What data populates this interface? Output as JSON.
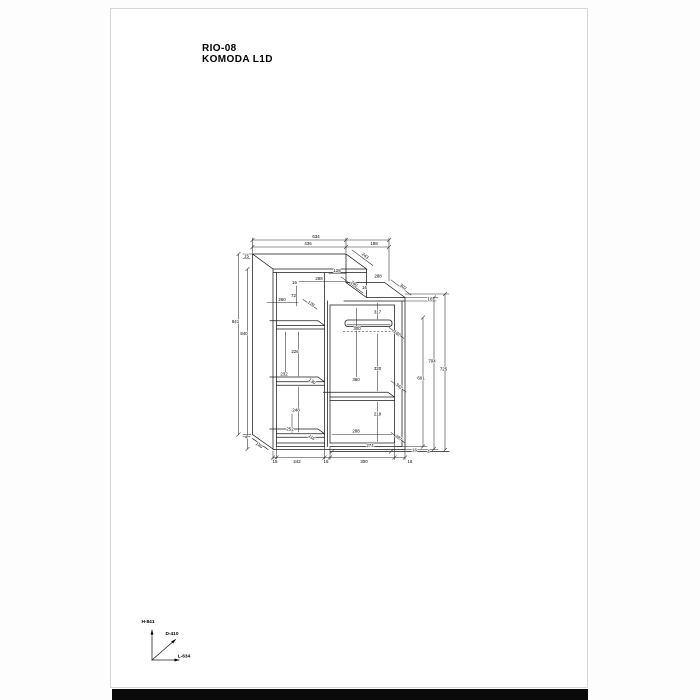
{
  "page": {
    "title_line1": "RIO-08",
    "title_line2": "KOMODA L1D"
  },
  "drawing": {
    "product_code": "RIO-08",
    "product_name": "KOMODA L1D",
    "line_color": "#1a1a1a",
    "page_background": "#ffffff",
    "axis_labels": [
      {
        "t": "H-841",
        "x": 148,
        "y": 621.5,
        "r": 0
      },
      {
        "t": "D-410",
        "x": 172,
        "y": 633.5,
        "r": 0
      },
      {
        "t": "L-634",
        "x": 184,
        "y": 656,
        "r": 0
      }
    ],
    "dimension_labels": [
      {
        "t": "634",
        "x": 316,
        "y": 237,
        "r": 0
      },
      {
        "t": "436",
        "x": 308,
        "y": 244,
        "r": 0
      },
      {
        "t": "198",
        "x": 374,
        "y": 244,
        "r": 0
      },
      {
        "t": "243",
        "x": 365,
        "y": 256,
        "r": 36
      },
      {
        "t": "15",
        "x": 246.5,
        "y": 256.5,
        "r": 0
      },
      {
        "t": "128",
        "x": 337,
        "y": 271,
        "r": 0
      },
      {
        "t": "288",
        "x": 319,
        "y": 279,
        "r": 0
      },
      {
        "t": "16",
        "x": 294.5,
        "y": 283,
        "r": 0
      },
      {
        "t": "240",
        "x": 354,
        "y": 284,
        "r": 36
      },
      {
        "t": "16",
        "x": 364.5,
        "y": 288,
        "r": 0
      },
      {
        "t": "288",
        "x": 378,
        "y": 276.5,
        "r": 0
      },
      {
        "t": "302",
        "x": 403,
        "y": 287,
        "r": 36
      },
      {
        "t": "72",
        "x": 293.5,
        "y": 296,
        "r": 0
      },
      {
        "t": "260",
        "x": 282,
        "y": 300,
        "r": 0
      },
      {
        "t": "128",
        "x": 311,
        "y": 304,
        "r": 36
      },
      {
        "t": "317",
        "x": 377.5,
        "y": 312.5,
        "r": 0
      },
      {
        "t": "16",
        "x": 430,
        "y": 299.5,
        "r": 0
      },
      {
        "t": "300",
        "x": 357,
        "y": 329,
        "r": 0
      },
      {
        "t": "182",
        "x": 397,
        "y": 333.5,
        "r": 36
      },
      {
        "t": "841",
        "x": 235.5,
        "y": 322,
        "r": 0
      },
      {
        "t": "840",
        "x": 244,
        "y": 334,
        "r": 0
      },
      {
        "t": "226",
        "x": 295,
        "y": 352,
        "r": 0
      },
      {
        "t": "232",
        "x": 284,
        "y": 374.5,
        "r": 0
      },
      {
        "t": "130",
        "x": 312,
        "y": 381.5,
        "r": 36
      },
      {
        "t": "248",
        "x": 296,
        "y": 410.5,
        "r": 0
      },
      {
        "t": "252",
        "x": 290,
        "y": 429.5,
        "r": 0
      },
      {
        "t": "116",
        "x": 311.5,
        "y": 437.5,
        "r": 36
      },
      {
        "t": "140",
        "x": 259,
        "y": 445.5,
        "r": 36
      },
      {
        "t": "4",
        "x": 246,
        "y": 437.5,
        "r": 0
      },
      {
        "t": "320",
        "x": 377.5,
        "y": 369,
        "r": 0
      },
      {
        "t": "360",
        "x": 356,
        "y": 380,
        "r": 0
      },
      {
        "t": "342",
        "x": 399,
        "y": 386.5,
        "r": 36
      },
      {
        "t": "219",
        "x": 377.5,
        "y": 414.5,
        "r": 0
      },
      {
        "t": "288",
        "x": 356,
        "y": 431.5,
        "r": 0
      },
      {
        "t": "287",
        "x": 398.5,
        "y": 438,
        "r": 36
      },
      {
        "t": "274",
        "x": 370,
        "y": 446,
        "r": 0
      },
      {
        "t": "601",
        "x": 421,
        "y": 378.5,
        "r": 0
      },
      {
        "t": "704",
        "x": 432,
        "y": 361.5,
        "r": 0
      },
      {
        "t": "725",
        "x": 443.5,
        "y": 369.5,
        "r": 0
      },
      {
        "t": "15",
        "x": 275,
        "y": 462,
        "r": 0
      },
      {
        "t": "242",
        "x": 297,
        "y": 462,
        "r": 0
      },
      {
        "t": "16",
        "x": 326,
        "y": 462,
        "r": 0
      },
      {
        "t": "300",
        "x": 364,
        "y": 462,
        "r": 0
      },
      {
        "t": "16",
        "x": 410,
        "y": 462,
        "r": 0
      },
      {
        "t": "16",
        "x": 414.5,
        "y": 450.5,
        "r": 0
      },
      {
        "t": "4",
        "x": 428.5,
        "y": 452,
        "r": 0
      }
    ]
  }
}
